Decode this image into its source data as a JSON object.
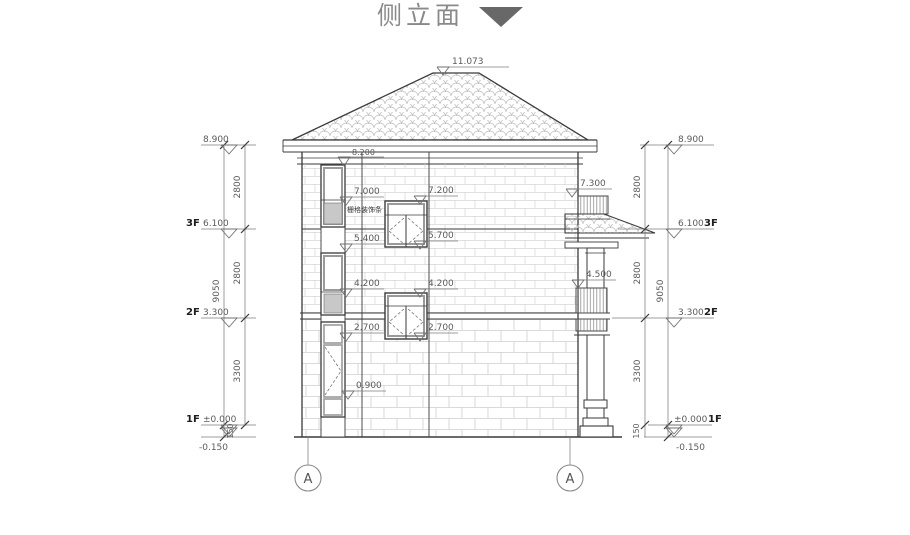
{
  "title": {
    "text": "侧立面"
  },
  "annotations": {
    "apex": "11.073",
    "eave": "8.200",
    "decor": "栅格装饰条",
    "left_col": [
      "7.000",
      "5.400",
      "4.200",
      "2.700",
      "0.900"
    ],
    "mid_col": [
      "7.200",
      "5.700",
      "4.200",
      "2.700"
    ],
    "right_col": [
      "7.300",
      "4.500"
    ]
  },
  "dims_left": {
    "overall": "9050",
    "floor_segs": [
      "2800",
      "2800",
      "3300"
    ],
    "plinth": "150",
    "levels": {
      "roof": "8.900",
      "f3": "6.100",
      "f2": "3.300",
      "f1": "±0.000",
      "ground": "-0.150"
    },
    "labels": {
      "f3": "3F",
      "f2": "2F",
      "f1": "1F"
    }
  },
  "dims_right": {
    "overall": "9050",
    "floor_segs": [
      "2800",
      "2800",
      "3300"
    ],
    "plinth": "150",
    "levels": {
      "roof": "8.900",
      "f3": "6.100",
      "f2": "3.300",
      "f1": "±0.000",
      "ground": "-0.150"
    },
    "labels": {
      "f3": "3F",
      "f2": "2F",
      "f1": "1F"
    }
  },
  "axes": {
    "a1": "A",
    "a2": "A"
  }
}
